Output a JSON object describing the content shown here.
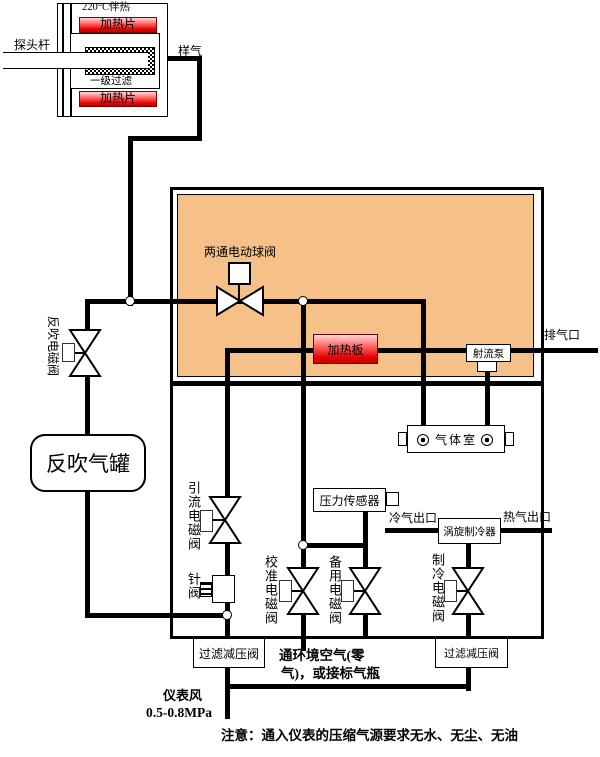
{
  "probe": {
    "temp_rating": "220°C伴热",
    "heater_top": "加热片",
    "heater_bottom": "加热片",
    "filter_stage": "一级过滤",
    "rod_label": "探头杆",
    "sample_gas_label": "样气"
  },
  "valves": {
    "two_way_ball": "两通电动球阀",
    "backflush_solenoid": "反吹电磁阀",
    "drain_solenoid": "引流电磁阀",
    "needle": "针阀",
    "calibration_solenoid": "校准电磁阀",
    "backup_solenoid": "备用电磁阀",
    "cooling_solenoid": "制冷电磁阀"
  },
  "components": {
    "heating_plate": "加热板",
    "jet_pump": "射流泵",
    "gas_chamber": "气体室",
    "pressure_sensor": "压力传感器",
    "vortex_cooler": "涡旋制冷器",
    "backflush_tank": "反吹气罐",
    "filter_regulator_left": "过滤减压阀",
    "filter_regulator_right": "过滤减压阀"
  },
  "ports": {
    "exhaust_outlet": "排气口",
    "cold_air_outlet": "冷气出口",
    "hot_air_outlet": "热气出口"
  },
  "annotations": {
    "ambient_air_line1": "通环境空气(零",
    "ambient_air_line2": "气)，或接标气瓶",
    "instrument_air": "仪表风",
    "instrument_air_pressure": "0.5-0.8MPa",
    "note": "注意：通入仪表的压缩气源要求无水、无尘、无油"
  },
  "colors": {
    "heated_enclosure_fill": "#F6C189",
    "heater_red": "#E80000",
    "pipe": "#000000"
  }
}
